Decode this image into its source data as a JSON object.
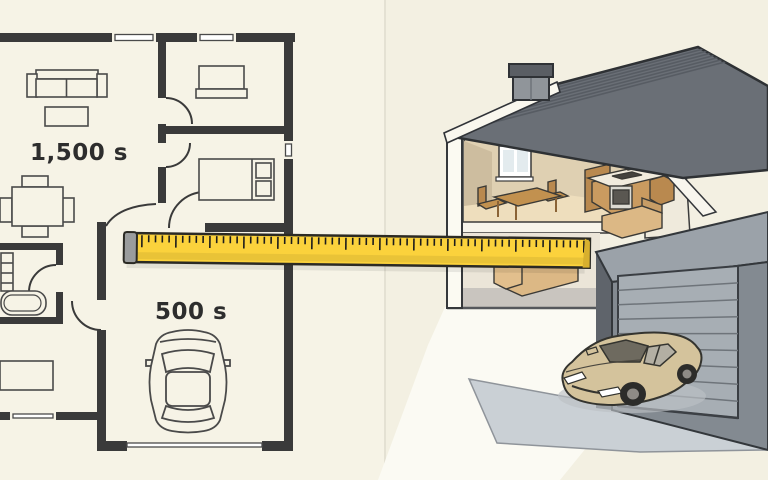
{
  "illustration": {
    "description": "split illustration: 2D floor plan with ruler measuring toward a 3D cutaway house",
    "left_panel": {
      "type": "floor-plan",
      "label_living": "1,500 s",
      "label_garage": "500 s",
      "icons": [
        "sofa-icon",
        "coffee-table-icon",
        "dining-table-icon",
        "dresser-icon",
        "bed-icon",
        "sink-shelf-icon",
        "bathtub-icon",
        "desk-icon",
        "car-top-view-icon",
        "door-arc-icon",
        "window-icon"
      ]
    },
    "ruler": {
      "icon": "ruler-icon",
      "style": "yellow tape ruler with black tick marks and gray end cap"
    },
    "right_panel": {
      "type": "cutaway-house-illustration",
      "icons": [
        "roof-icon",
        "chimney-icon",
        "window-icon",
        "dining-set-icon",
        "kitchen-cabinets-icon",
        "stove-icon",
        "sofa-icon",
        "floor-slab-icon",
        "garage-icon",
        "garage-door-icon",
        "driveway-icon",
        "car-icon"
      ]
    },
    "colors": {
      "background_left": "#f6f3e6",
      "background_right": "#f3f0e2",
      "wall_dark": "#3a3a3a",
      "label_text": "#2d2d2d",
      "ruler_yellow": "#fbd23c",
      "ruler_cap_gray": "#9a9c9d",
      "roof_gray": "#6a6f76",
      "wood_brown": "#c99c61",
      "interior_tan": "#dfd0b2",
      "garage_front_gray": "#838a91",
      "garage_top_gray": "#9ba2a9",
      "garage_door_gray": "#a7aeb4",
      "driveway_gray": "#cad0d5",
      "car_beige": "#d4c39c"
    }
  }
}
